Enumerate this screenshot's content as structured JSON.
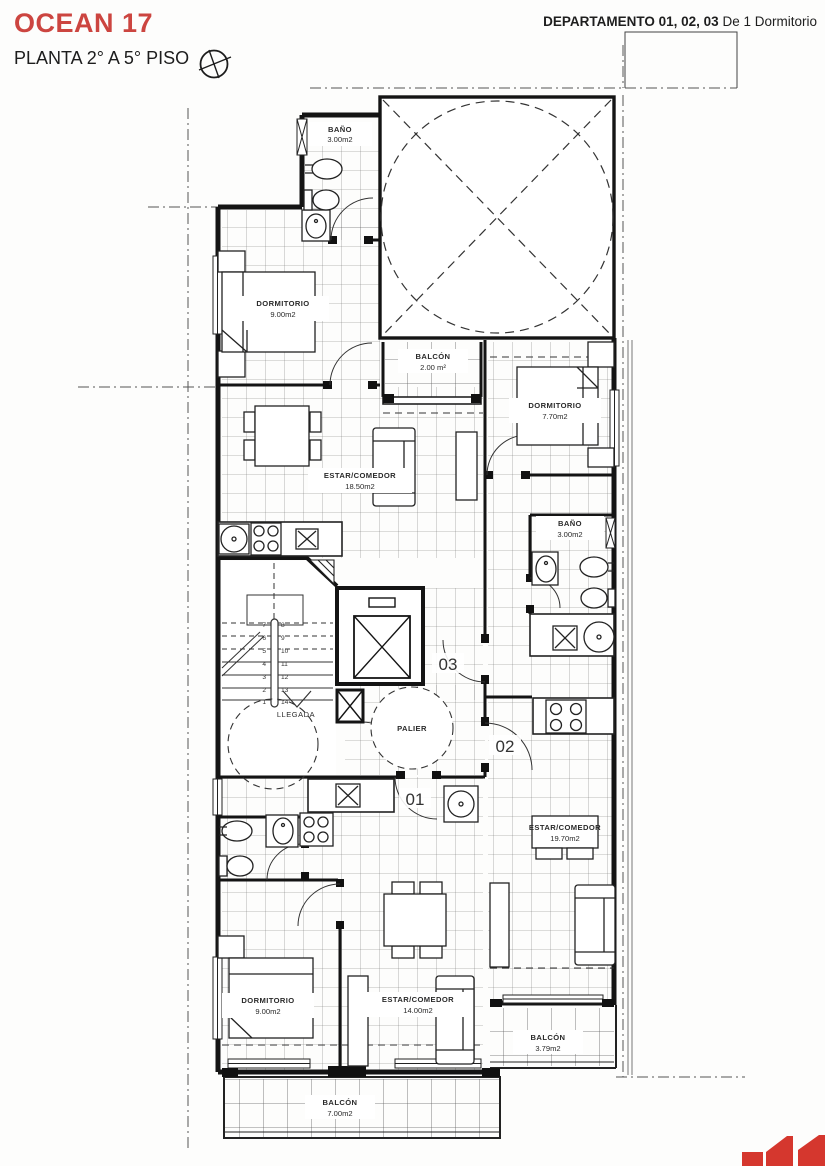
{
  "header": {
    "project_title": "OCEAN 17",
    "floor_label": "PLANTA 2° A 5° PISO",
    "apartments_bold": "DEPARTAMENTO 01, 02, 03",
    "apartments_regular": "De 1 Dormitorio"
  },
  "rooms": {
    "bano_03": {
      "name": "BAÑO",
      "area": "3.00m2"
    },
    "dorm_03": {
      "name": "DORMITORIO",
      "area": "9.00m2"
    },
    "balcon_03": {
      "name": "BALCÓN",
      "area": "2.00 m²"
    },
    "dorm_02": {
      "name": "DORMITORIO",
      "area": "7.70m2"
    },
    "estar_03": {
      "name": "ESTAR/COMEDOR",
      "area": "18.50m2"
    },
    "bano_02": {
      "name": "BAÑO",
      "area": "3.00m2"
    },
    "estar_02": {
      "name": "ESTAR/COMEDOR",
      "area": "19.70m2"
    },
    "dorm_01": {
      "name": "DORMITORIO",
      "area": "9.00m2"
    },
    "estar_01": {
      "name": "ESTAR/COMEDOR",
      "area": "14.00m2"
    },
    "balcon_02": {
      "name": "BALCÓN",
      "area": "3.79m2"
    },
    "balcon_01": {
      "name": "BALCÓN",
      "area": "7.00m2"
    }
  },
  "core": {
    "palier": "PALIER",
    "llegada": "LLEGADA",
    "unit_01": "01",
    "unit_02": "02",
    "unit_03": "03"
  },
  "stairs": {
    "left": [
      "7",
      "6",
      "5",
      "4",
      "3",
      "2",
      "1"
    ],
    "right": [
      "8",
      "9",
      "10",
      "11",
      "12",
      "13",
      "14"
    ]
  },
  "colors": {
    "accent_red": "#cc4540",
    "logo_red": "#d5372e",
    "line_dark": "#141414"
  }
}
